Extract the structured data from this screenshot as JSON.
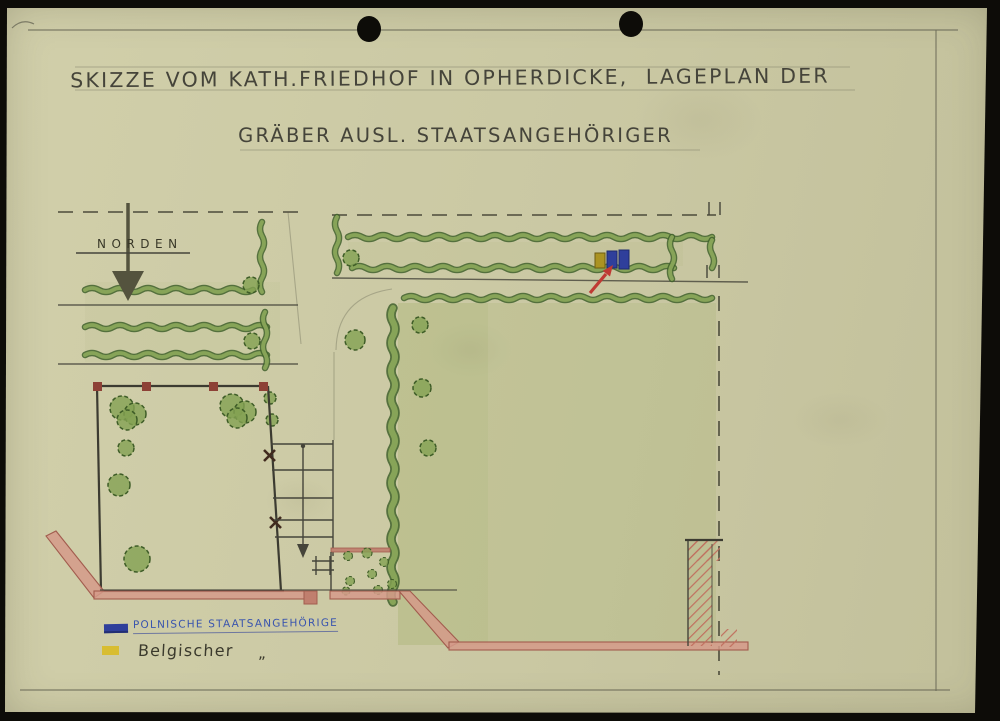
{
  "title": {
    "line1": "SKIZZE VOM KATH.FRIEDHOF IN OPHERDICKE,  LAGEPLAN DER",
    "line2": "GRÄBER AUSL. STAATSANGEHÖRIGER"
  },
  "plan": {
    "north_label": "NORDEN",
    "grave_markers": [
      {
        "name": "belgian-grave",
        "color": "#ab9322"
      },
      {
        "name": "polish-grave-1",
        "color": "#2f3f9b"
      },
      {
        "name": "polish-grave-2",
        "color": "#2f3f9b"
      }
    ],
    "pointer_arrow_color": "#bf3a33"
  },
  "legend": {
    "items": [
      {
        "label": "POLNISCHE STAATSANGEHÖRIGE",
        "swatch_color": "#2f3f9b",
        "text_color": "#3a55ae"
      },
      {
        "label": "Belgischer",
        "ditto_mark": "„",
        "swatch_color": "#d8bd32",
        "text_color": "#3b3a2d"
      }
    ]
  },
  "colors": {
    "paper": "#cac8a3",
    "scan_border": "#0d0c08",
    "ink": "#45443a",
    "pencil": "#6e6d5b",
    "hedge_dark": "#40602c",
    "hedge_light": "#8aa65a",
    "field_wash": "#94a555",
    "road_fill": "#d59a89",
    "road_stroke": "#a25c4e",
    "fence_post_red": "#8d4136",
    "arrow_red": "#bf3a33",
    "marker_blue": "#2f3f9b",
    "marker_yellow": "#ab9322"
  }
}
